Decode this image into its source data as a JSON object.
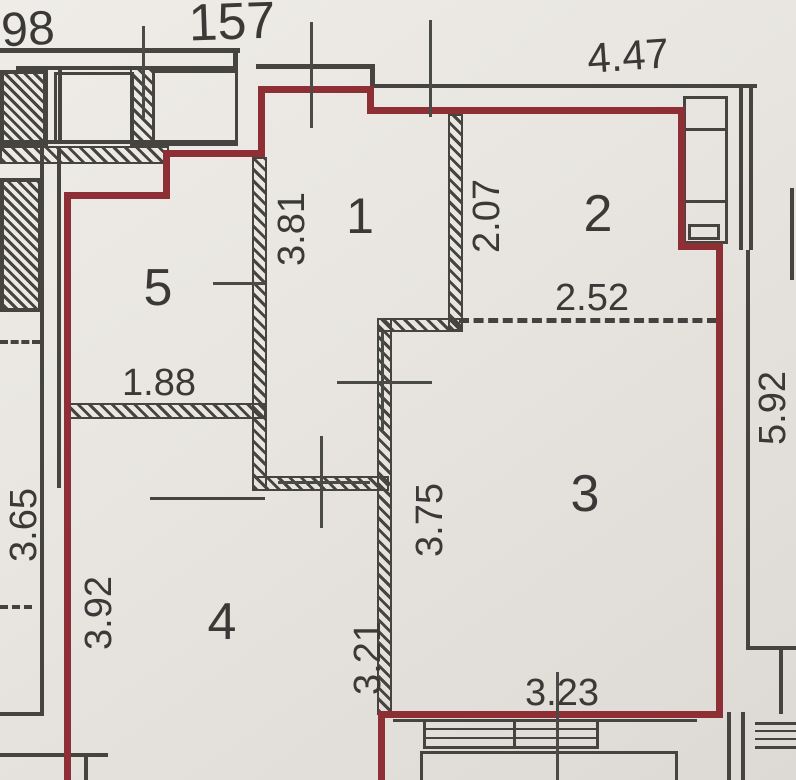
{
  "plan": {
    "apartment_number": "157",
    "neighbor_label_partial": "98",
    "rooms": [
      {
        "number": "1"
      },
      {
        "number": "2"
      },
      {
        "number": "3"
      },
      {
        "number": "4"
      },
      {
        "number": "5"
      }
    ],
    "dimensions": {
      "top_width": "4.47",
      "hall_height": "3.81",
      "room2_left_height": "2.07",
      "room2_bottom_width": "2.52",
      "right_outer_height": "5.92",
      "room5_width": "1.88",
      "outer_left_height": "3.65",
      "room4_left_height": "3.92",
      "room3_wall_height": "3.75",
      "room4_right_height": "3.21",
      "bottom_window_width": "3.23"
    },
    "colors": {
      "apartment_outline": "#8e2e35",
      "wall_line": "#45443f",
      "paper": "#e9e6e1",
      "text": "#3b3937"
    }
  }
}
